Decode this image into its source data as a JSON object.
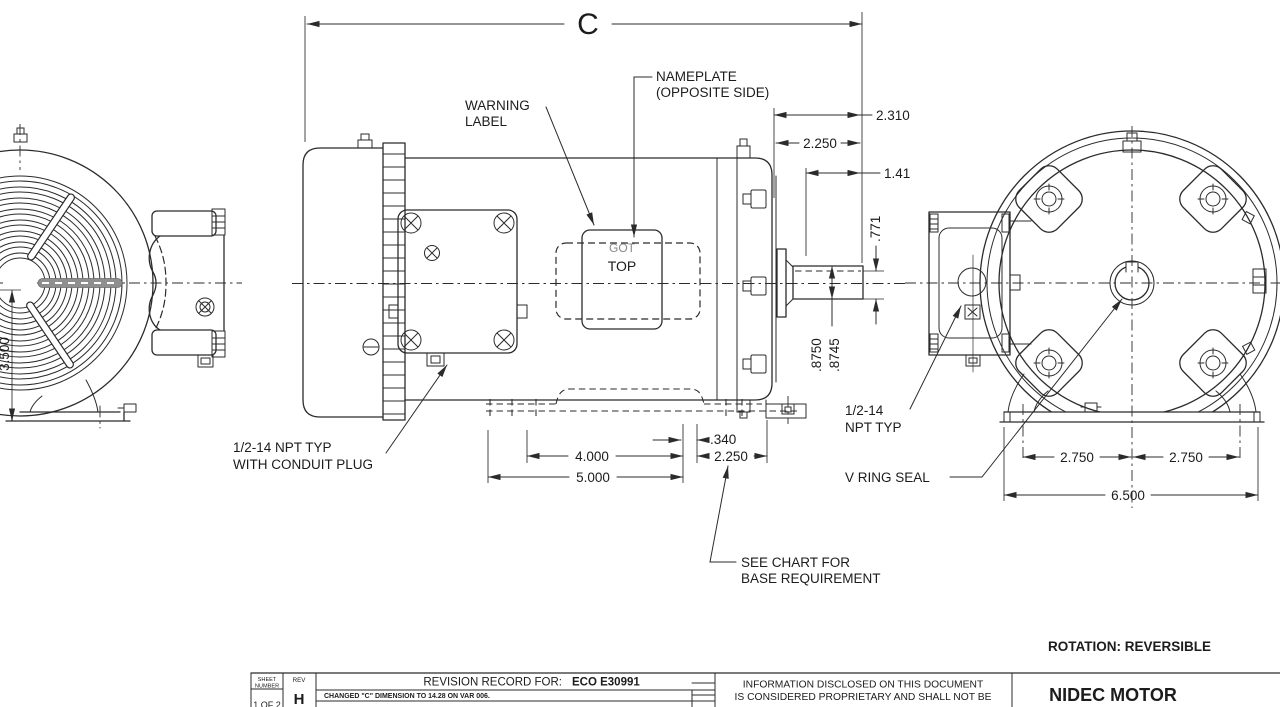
{
  "labels": {
    "warning_1": "WARNING",
    "warning_2": "LABEL",
    "nameplate_1": "NAMEPLATE",
    "nameplate_2": "(OPPOSITE SIDE)",
    "plate_1": "GOT",
    "plate_2": "TOP",
    "conduit_1": "1/2-14 NPT TYP",
    "conduit_2": "WITH CONDUIT PLUG",
    "see_chart_1": "SEE CHART FOR",
    "see_chart_2": "BASE REQUIREMENT",
    "npt_1": "1/2-14",
    "npt_2": "NPT TYP",
    "v_ring": "V RING SEAL",
    "rotation": "ROTATION:  REVERSIBLE"
  },
  "dims": {
    "c": "C",
    "d2310": "2.310",
    "d2250_top": "2.250",
    "d141": "1.41",
    "d771": ".771",
    "dia1": ".8750",
    "dia2": ".8745",
    "d340": ".340",
    "d4000": "4.000",
    "d2250_base": "2.250",
    "d5000": "5.000",
    "d3500": "3.500",
    "d2750l": "2.750",
    "d2750r": "2.750",
    "d6500": "6.500"
  },
  "title_block": {
    "sheet_1": "SHEET",
    "sheet_2": "NUMBER",
    "sheet_value": "1 OF 2",
    "rev_label": "REV",
    "rev_value": "H",
    "record_label": "REVISION RECORD FOR:",
    "record_eco": "ECO E30991",
    "revision_note": "CHANGED \"C\" DIMENSION TO 14.28 ON VAR 006.",
    "proprietary_1": "INFORMATION DISCLOSED ON THIS DOCUMENT",
    "proprietary_2": "IS CONSIDERED PROPRIETARY AND SHALL NOT BE",
    "company": "NIDEC MOTOR"
  },
  "colors": {
    "line": "#2b2b2b",
    "key_gray": "#8f8f8f",
    "background": "#ffffff"
  }
}
